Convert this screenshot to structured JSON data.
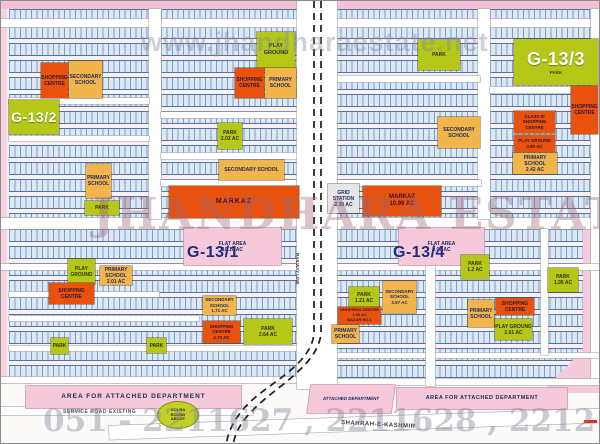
{
  "watermarks": {
    "top": "www.jhandharaestate.net",
    "center": "JHANDHARA ESTATE",
    "phones": "051 - 2211627 , 2211628 , 2212188"
  },
  "sectors": {
    "g13_1": "G-13/1",
    "g13_2": "G-13/2",
    "g13_3": "G-13/3",
    "g13_3_sub": "PARK",
    "g13_4": "G-13/4"
  },
  "roads": {
    "service": "SERVICE ROAD EXISTING",
    "shahrah": "SHAHRAH-E-KASHMIR",
    "railway": "RAILWAY LINE",
    "roundabout": "GOLRA\nROUND\nABOUT"
  },
  "blocks": {
    "sc_g2_top": "SHOPPING\nCENTRE",
    "ss_g2_top": "SECONDARY\nSCHOOL",
    "ps_g2_left": "PRIMARY\nSCHOOL",
    "park_g2_left": "PARK",
    "pg_g2": "PLAY GROUND",
    "sc_g2_mid": "SHOPPING\nCENTRE",
    "ps_g2_mid": "PRIMARY\nSCHOOL",
    "park_g2_mid": "PARK\n2.02 AC",
    "ss_g2_big": "SECONDARY SCHOOL",
    "markaz_w": "MARKAZ",
    "park_g3": "PARK",
    "sc_g3_edge": "SHOPPING\nCENTRE",
    "ss_g3": "SECONDARY\nSCHOOL",
    "sc_g3": "CLASS III\nSHOPPING CENTRE",
    "pg_g3": "PLAY GROUND\n4.80 AC",
    "ps_g3": "PRIMARY SCHOOL\n2.42 AC",
    "grid": "GRID\nSTATION\n2.30 AC",
    "markaz_e": "MARKAZ\n10.96 AC",
    "flat_g1": "FLAT AREA\n10.10 AC",
    "flat_g4": "FLAT AREA\n9.09 AC",
    "pg_g1": "PLAY GROUND",
    "ps_g1": "PRIMARY SCHOOL\n2.01 AC",
    "sc_g1": "SHOPPING CENTRE",
    "ss_g1": "SECONDARY SCHOOL\n1.71 AC",
    "sc_g1b": "SHOPPING CENTRE\n2.73 AC",
    "park_g1": "PARK\n2.64 AC",
    "park_g1a": "PARK",
    "park_g1b": "PARK",
    "park_g4a": "PARK\n1.2 AC",
    "park_g4b": "PARK\n1.95 AC",
    "park_g4c": "PARK\n1.21 AC",
    "ss_g4": "SECONDARY\nSCHOOL\n3.97 AC",
    "sc_g4a": "SHOPPING CENTRE\n1.30 AC\nBAZAR NO.1",
    "ps_g4a": "PRIMARY\nSCHOOL",
    "ps_g4b": "PRIMARY\nSCHOOL",
    "sc_g4b": "SHOPPING\nCENTRE",
    "pg_g4": "PLAY GROUND\n2.61 AC",
    "dept_l": "AREA FOR ATTACHED DEPARTMENT",
    "dept_m": "ATTACHED DEPARTMENT",
    "dept_r": "AREA FOR ATTACHED DEPARTMENT"
  }
}
